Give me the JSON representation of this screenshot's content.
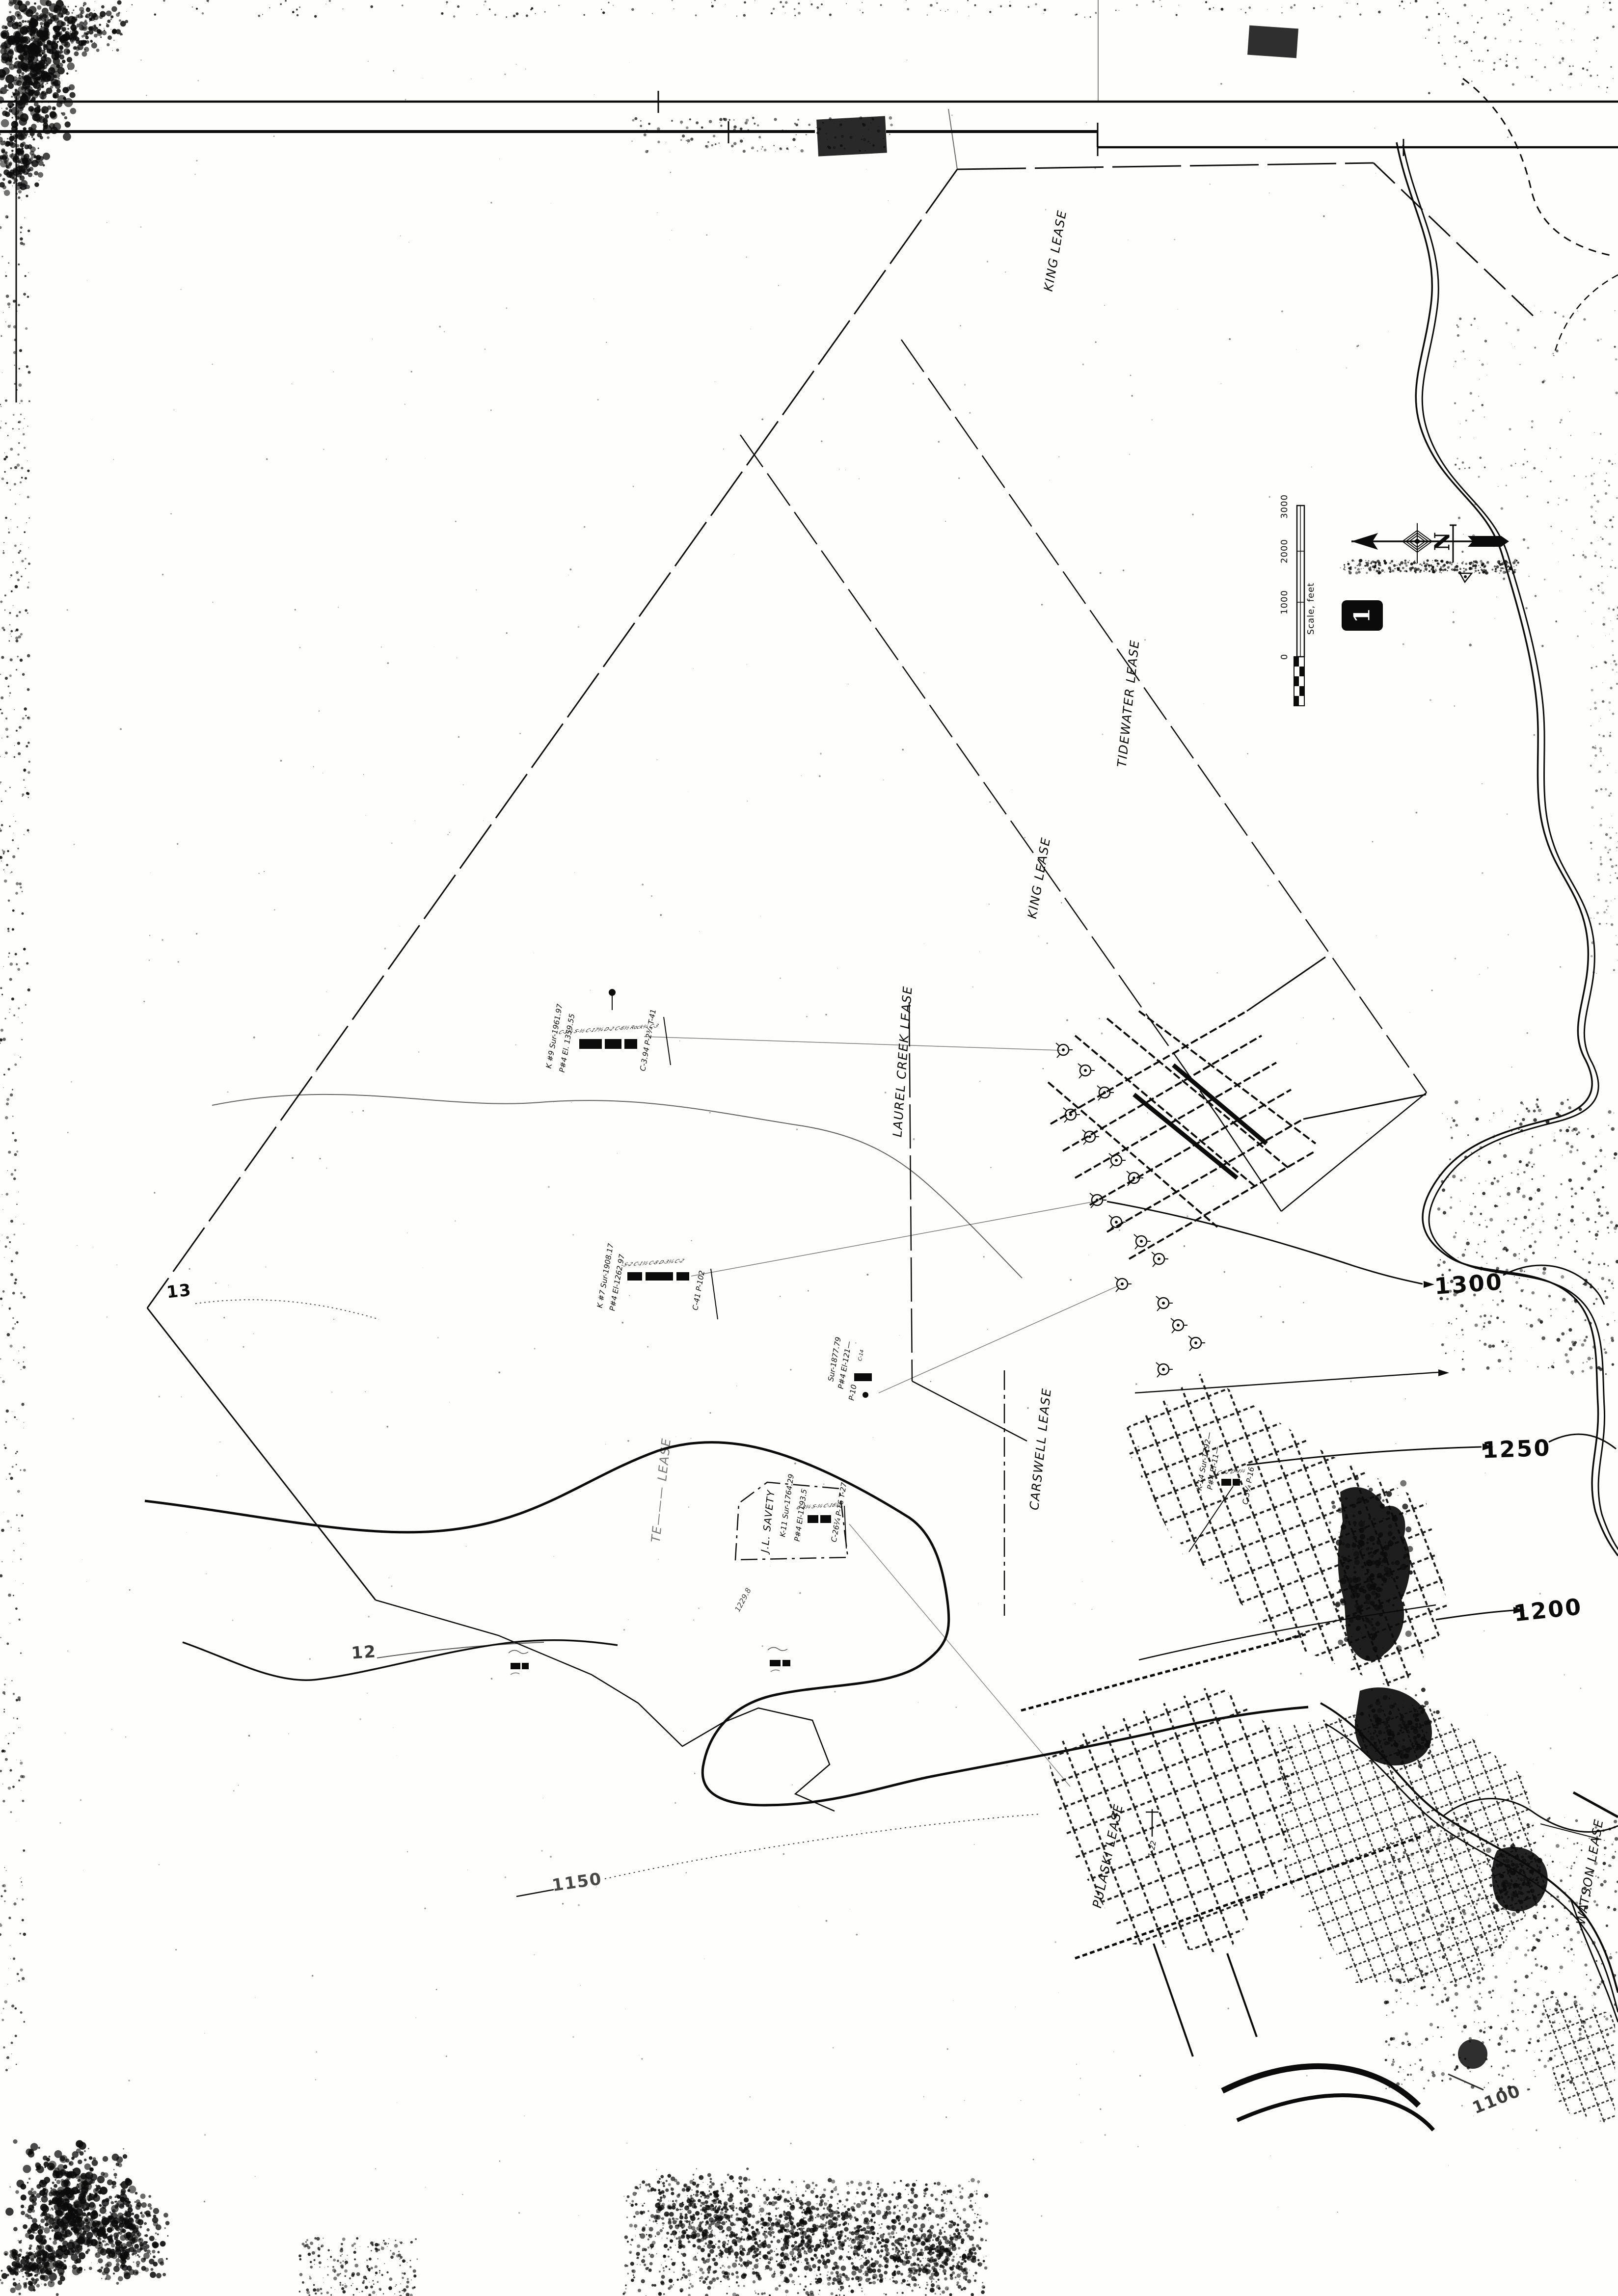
{
  "colors": {
    "paper": "#fefefd",
    "ink": "#0b0b0b"
  },
  "map": {
    "leases": {
      "king_north": "KING LEASE",
      "tidewater": "TIDEWATER LEASE",
      "king_south": "KING LEASE",
      "laurel_creek": "LAUREL CREEK LEASE",
      "carswell": "CARSWELL LEASE",
      "te_partial": "TE——— LEASE",
      "pulaski": "PULASKI LEASE",
      "watson": "WATSON LEASE",
      "jl_savety": "J.L. SAVETY"
    },
    "contour_labels": {
      "c1300": "1300",
      "c1250": "1250",
      "c1200": "1200",
      "c1150": "1150",
      "c1100": "1100",
      "c13": "13",
      "c12": "12"
    },
    "scale_bar": {
      "caption": "Scale, feet",
      "ticks": [
        "3000",
        "2000",
        "1000",
        "0"
      ]
    },
    "north_arrow": {
      "letter": "N"
    },
    "figure_number": "1",
    "wells": [
      {
        "name": "K #9  Sur-1961.97",
        "elev": "P#4 El. 1359.55",
        "casing": "C-1¼ S-½ C-17¾ D-2 C-6½ Rock¼ C-3",
        "totals": "C-3.94  P-2¾  T-41"
      },
      {
        "name": "K #7  Sur-1908.17",
        "elev": "P#4 El-1262.97",
        "casing": "S-2 C-1½ C-8 D-3¼ C-2",
        "totals": "C-41  P-102"
      },
      {
        "name": "Sur-1877.79",
        "elev": "P#4 El-121—",
        "casing": "C-14",
        "totals": "P-10"
      },
      {
        "name": "K-11  Sur-1764.29",
        "elev": "P#4 El-1193.5",
        "casing": "C-8¼ S-¼ C-16¼",
        "totals": "C-26¼  P-16  T-27"
      },
      {
        "name": "K-14  Sur-1792—",
        "elev": "P#4 El-11—",
        "casing": "C-32 D-4¼",
        "totals": "C-5¼  P-16"
      }
    ],
    "annotations": {
      "well_1_22": "1-22",
      "elev_1229": "1229.8"
    }
  }
}
